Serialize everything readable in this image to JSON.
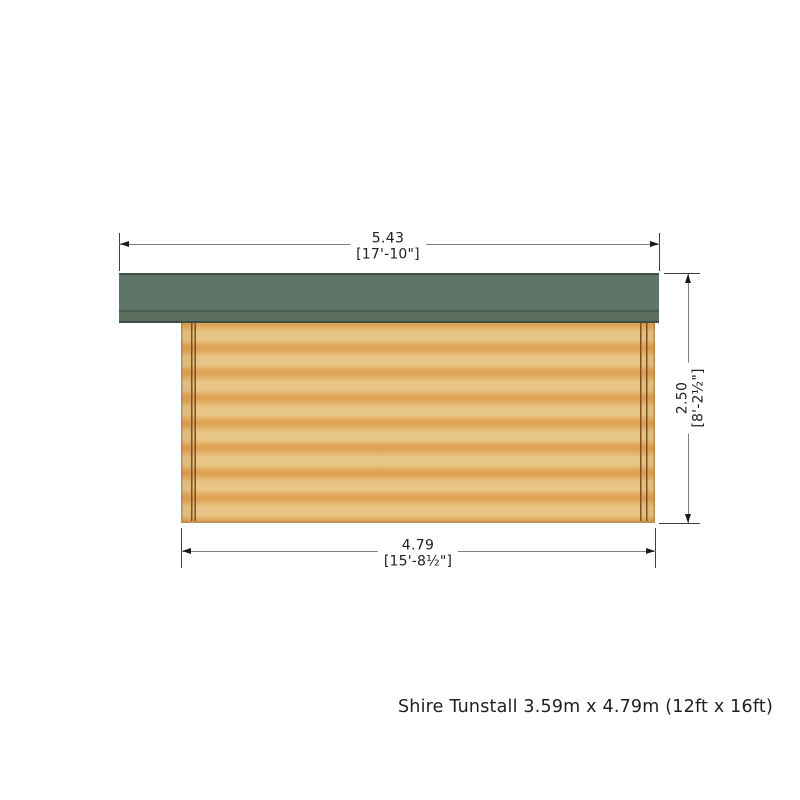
{
  "drawing": {
    "caption": "Shire Tunstall 3.59m x 4.79m (12ft x 16ft)",
    "dimensions": {
      "roof_width": {
        "metric": "5.43",
        "imperial": "[17'-10\"]"
      },
      "building_height": {
        "metric": "2.50",
        "imperial": "[8'-2½\"]"
      },
      "wall_width": {
        "metric": "4.79",
        "imperial": "[15'-8½\"]"
      }
    },
    "colors": {
      "roof_main": "#5e7567",
      "roof_edge": "#3f4f44",
      "roof_divider": "#4a5b4f",
      "roof_fascia": "#5a6d5f",
      "wall_light": "#e7c586",
      "wall_mid": "#e2ae62",
      "wall_orange": "#df9f50",
      "wall_edge": "#bb8a43",
      "wall_base": "#c0914e",
      "post_line": "#7f4f1d",
      "dim_line": "#7f7f7f",
      "ext_line": "#404040",
      "arrow": "#1a1a1a",
      "text": "#1f1f1f"
    }
  }
}
